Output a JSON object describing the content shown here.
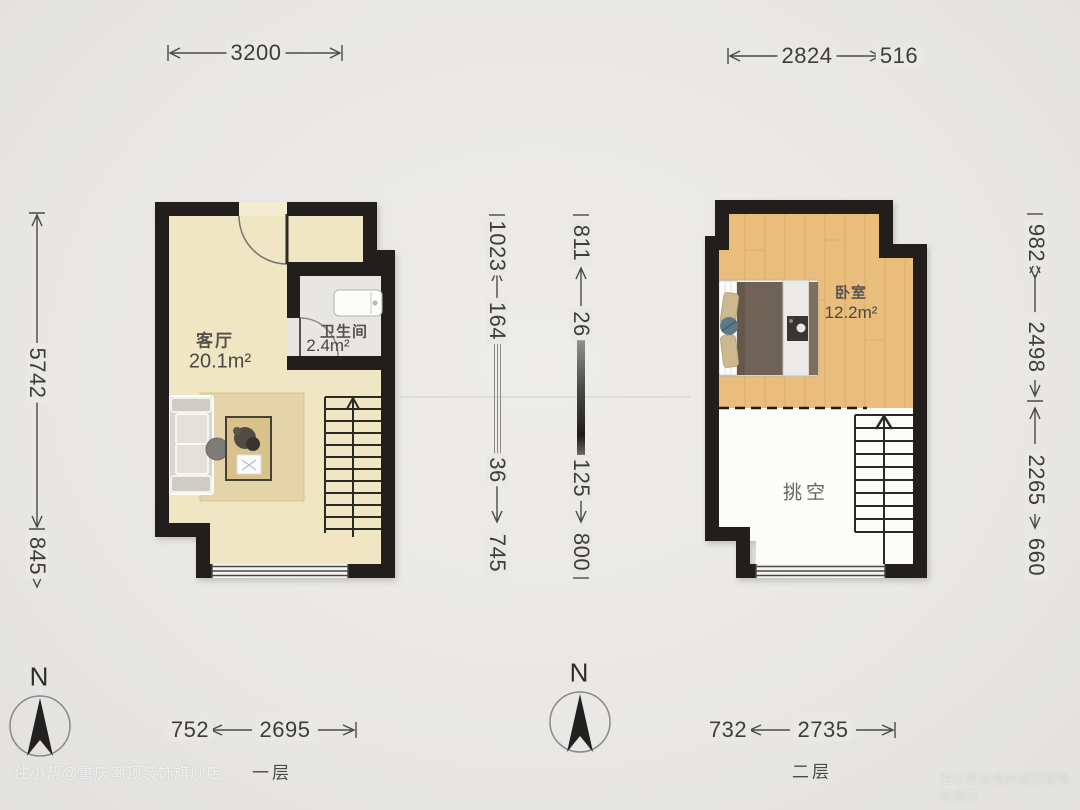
{
  "floor1": {
    "label": "一层",
    "rooms": {
      "living": {
        "name": "客厅",
        "area": "20.1m²"
      },
      "bathroom": {
        "name": "卫生间",
        "area": "2.4m²"
      }
    },
    "dims": {
      "top_width": "3200",
      "left_height": "5742",
      "left_lower": "845",
      "bottom_offset": "752",
      "bottom_width": "2695"
    }
  },
  "floor2": {
    "label": "二层",
    "rooms": {
      "bedroom": {
        "name": "卧室",
        "area": "12.2m²"
      },
      "void": {
        "name": "挑空"
      }
    },
    "dims": {
      "top_width": "2824",
      "top_right": "516",
      "right_chain": [
        "982",
        "2498",
        "2265",
        "660"
      ],
      "bottom_offset": "732",
      "bottom_width": "2735"
    }
  },
  "middle_dims": {
    "left_chain": [
      "1023",
      "164",
      "36",
      "745"
    ],
    "right_chain": [
      "811",
      "26",
      "125",
      "800"
    ]
  },
  "compass": {
    "north_label": "N"
  },
  "watermark": {
    "text": "住小帮@重庆潮顶装饰旗舰店"
  },
  "colors": {
    "background": "#e9e8e6",
    "wall": "#211e1b",
    "living_floor": "#f0e6c3",
    "bathroom_floor": "#e7e6e4",
    "wood_floor": "#e9bd7c",
    "void_floor": "#fcfcfa",
    "rug": "#e3d5a9",
    "blanket": "#6f6357",
    "dimension_text": "#3e3d3b"
  }
}
